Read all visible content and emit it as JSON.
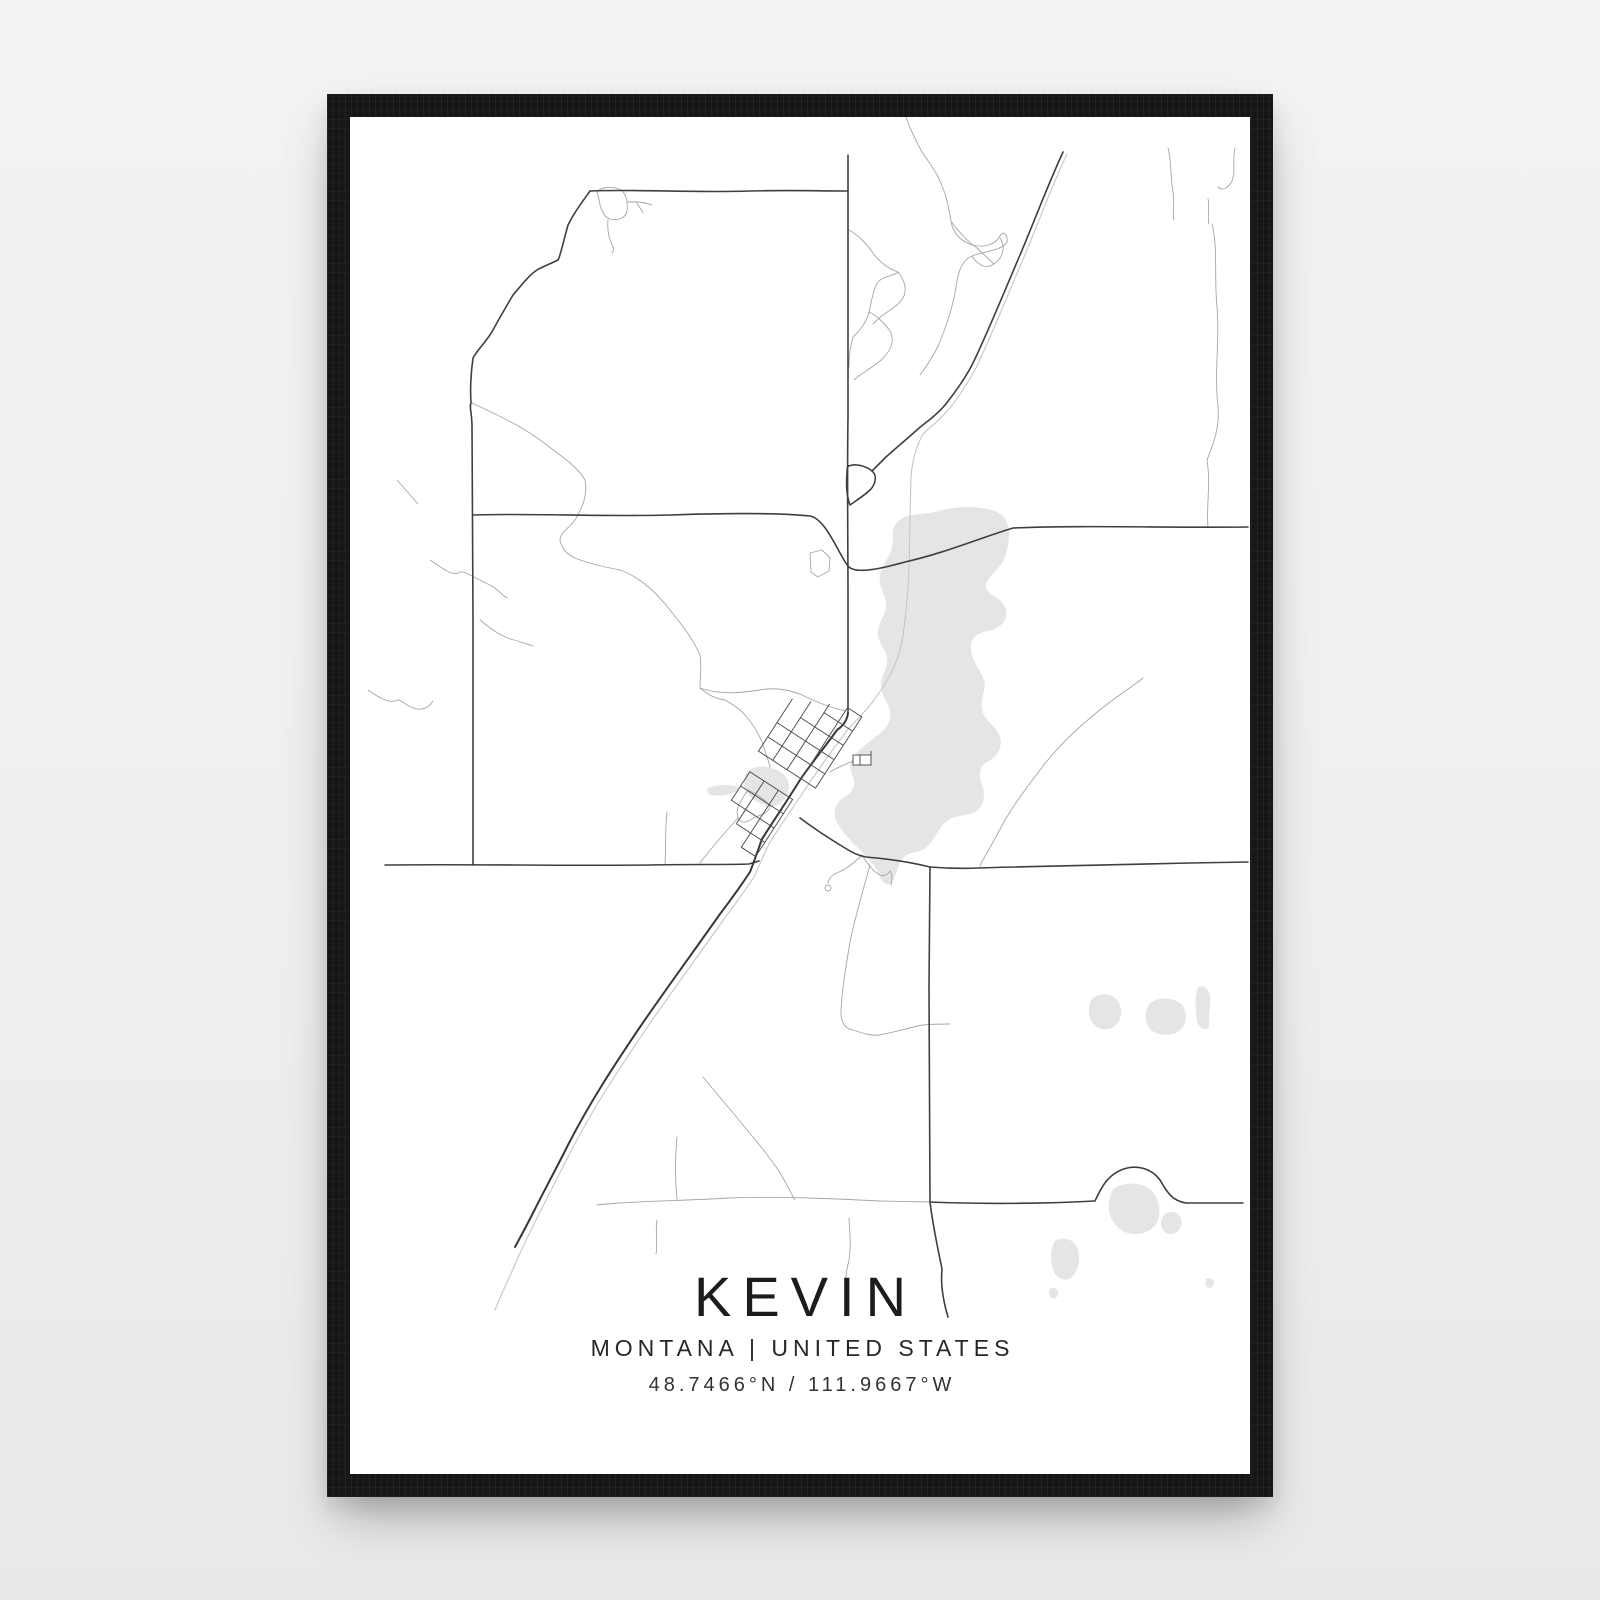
{
  "poster": {
    "title": "KEVIN",
    "subtitle": "MONTANA | UNITED STATES",
    "coordinates": "48.7466°N / 111.9667°W"
  },
  "location": {
    "city": "Kevin",
    "state": "Montana",
    "country": "United States",
    "latitude": "48.7466°N",
    "longitude": "111.9667°W"
  },
  "artwork": {
    "kind": "minimalist street map poster",
    "frame_style": "black wood frame",
    "map_features": [
      "town street grid",
      "highway with parallel railroad",
      "section-line roads",
      "lake",
      "small ponds",
      "creeks"
    ]
  },
  "colors": {
    "background": "#f0f0f0",
    "frame": "#161616",
    "paper": "#ffffff",
    "road_dark": "#3f3f3f",
    "road_light": "#a6a6a6",
    "railway": "#c6c6c6",
    "water": "#e5e5e7",
    "text": "#222222"
  }
}
